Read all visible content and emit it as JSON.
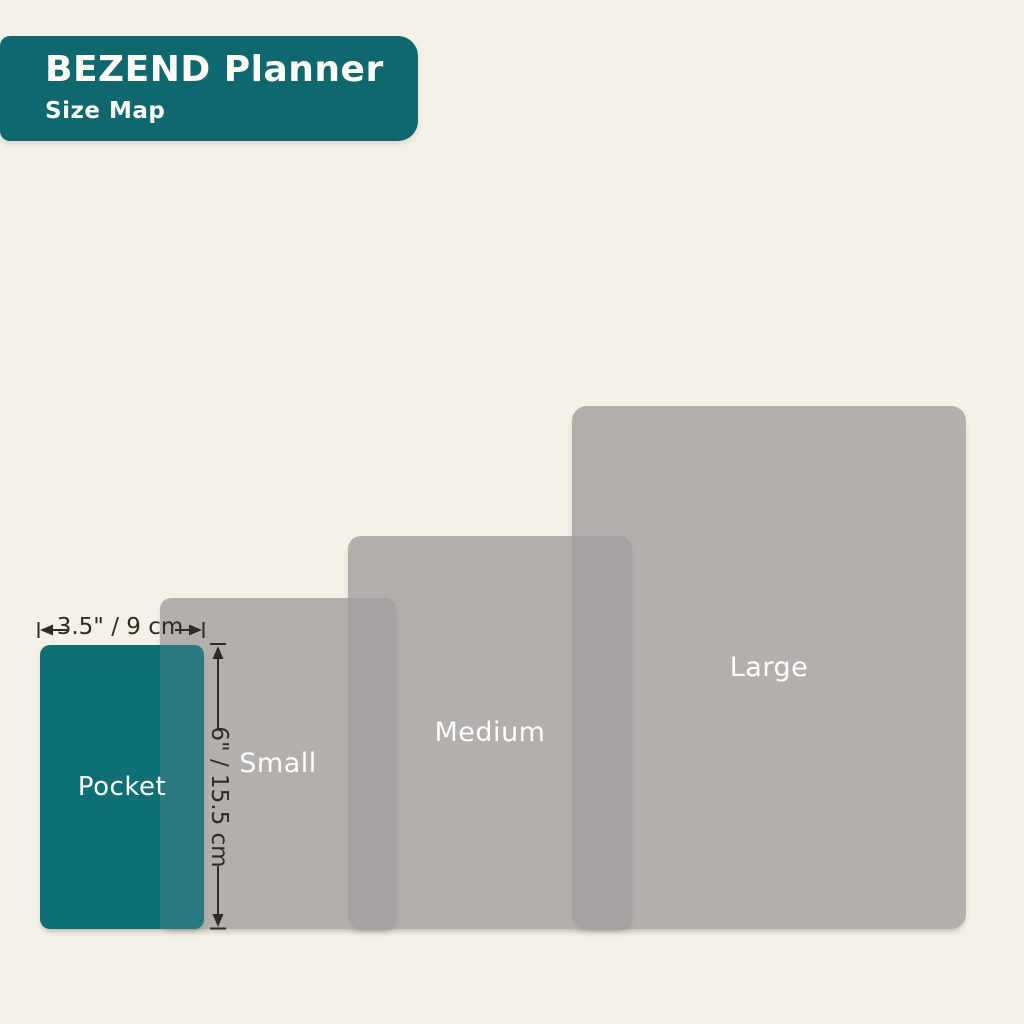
{
  "header": {
    "title": "BEZEND Planner",
    "subtitle": "Size Map"
  },
  "sizes": [
    {
      "label": "Pocket"
    },
    {
      "label": "Small"
    },
    {
      "label": "Medium"
    },
    {
      "label": "Large"
    }
  ],
  "dimensions": {
    "width_label": "3.5\" / 9 cm",
    "height_label": "6\" / 15.5 cm"
  },
  "colors": {
    "background": "#f4f1e8",
    "header_teal": "#0e686e",
    "pocket_teal": "#0e6f74",
    "pocket_overlap_teal": "#297a7e",
    "size_gray": "#b1afac",
    "size_gray_overlap": "#a4a2a0",
    "annotation": "#2e2c2a",
    "label_text": "#ffffff"
  }
}
